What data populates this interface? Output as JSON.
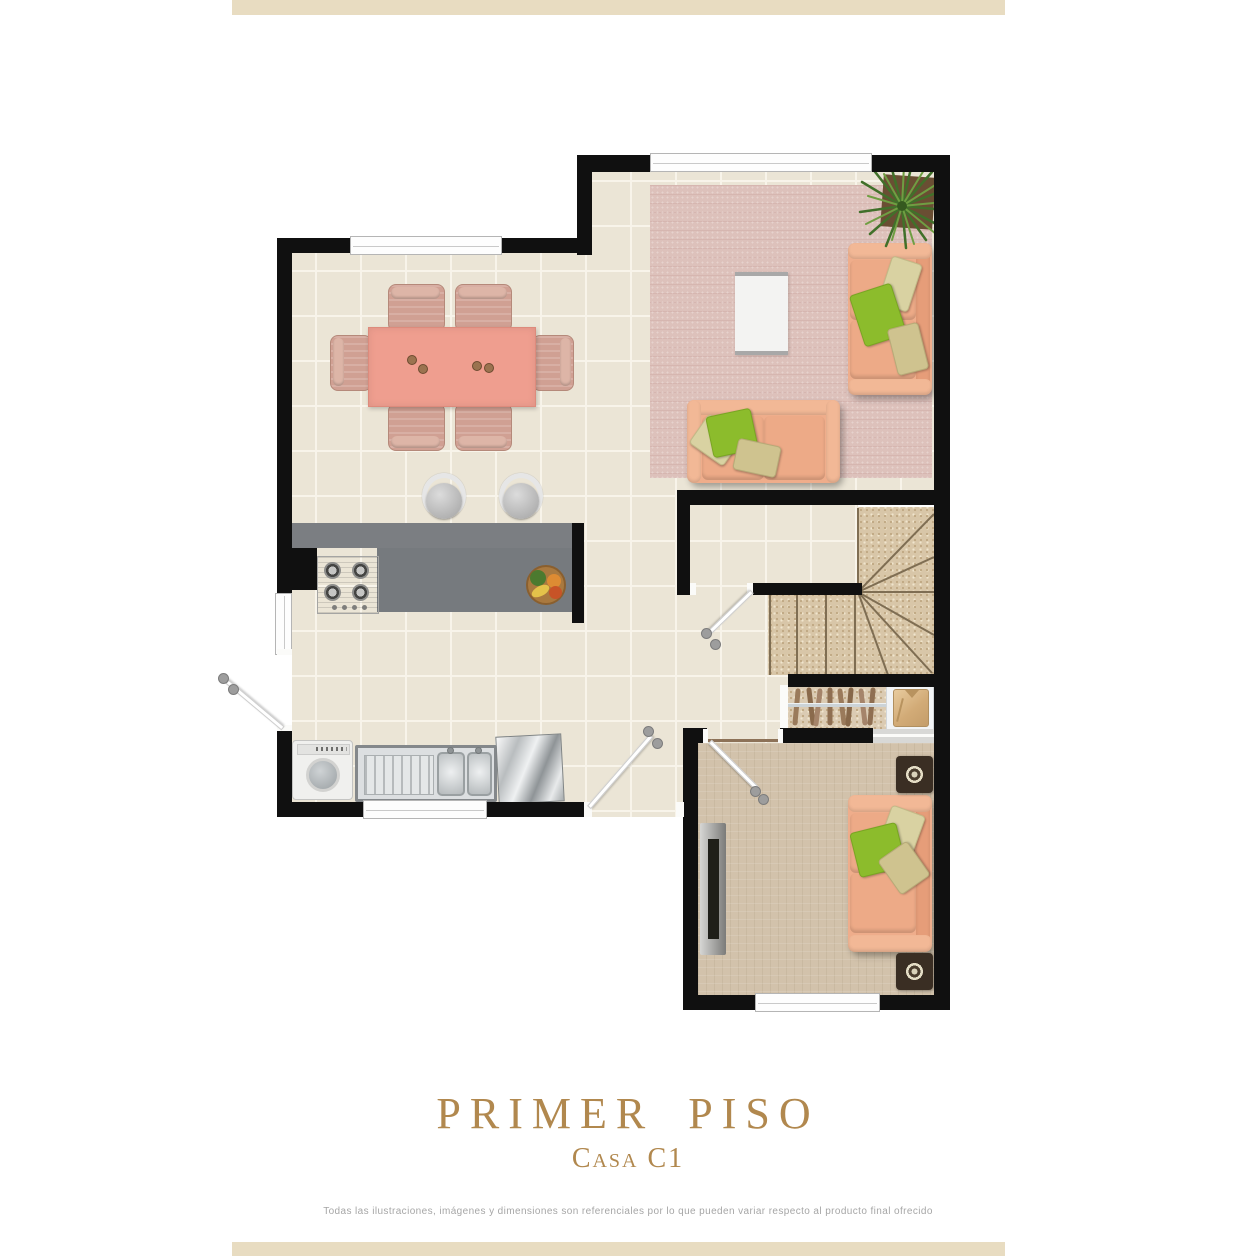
{
  "page": {
    "top_bar_color": "#e8dcc1",
    "bottom_bar_color": "#e8dcc1",
    "background": "#ffffff"
  },
  "title_block": {
    "title": "PRIMER  PISO",
    "subtitle": "Casa C1",
    "title_color": "#b1884e"
  },
  "disclaimer": "Todas las ilustraciones, imágenes y dimensiones son referenciales por lo que pueden variar respecto al producto final ofrecido",
  "floor_plan": {
    "type": "architectural-top-view",
    "wall_color": "#101010",
    "floor_tile_color": "#ebe5d6",
    "living_rug_color": "#ddc1bb",
    "tv_carpet_color": "#d2c2ab",
    "stairs_carpet_color": "#d8c6a8",
    "kitchen_counter_color": "#7b7e82",
    "dining_table_color": "#ef9e8f",
    "sofa_color": "#efad8b",
    "pillow_green_color": "#8cbc2c",
    "pillow_cream_color": "#d9d2a2",
    "elements": [
      "windows",
      "doors",
      "dining-table-with-six-chairs",
      "two-bar-stools",
      "kitchen-counter",
      "stove",
      "fruit-bowl",
      "washing-machine",
      "double-sink",
      "metal-board",
      "living-rug",
      "two-sofas",
      "coffee-table",
      "plant",
      "winder-staircase",
      "under-stair-closet",
      "tv-panel",
      "tv-sofa",
      "two-speakers"
    ]
  }
}
